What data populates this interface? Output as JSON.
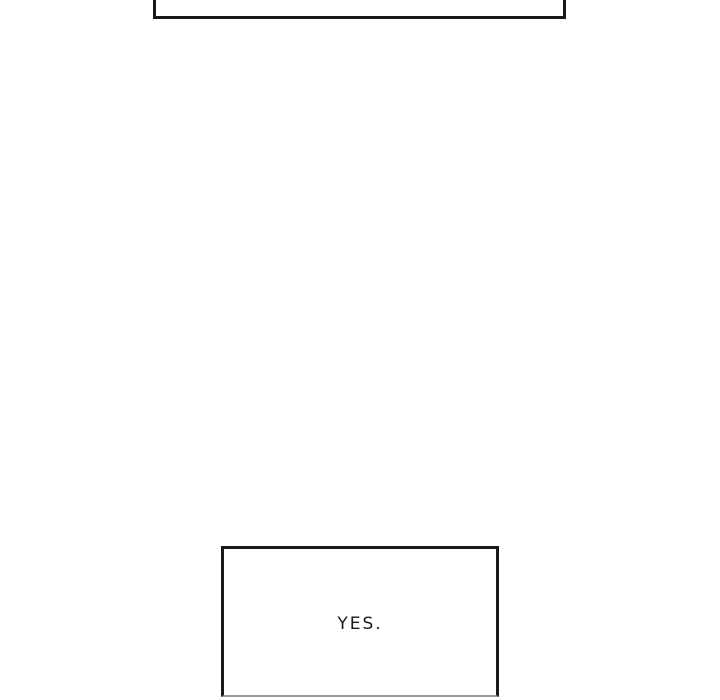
{
  "comic": {
    "background_color": "#ffffff",
    "panel_border_color": "#1a1a1a",
    "panel_bottom_edge_color": "#9a9a9a",
    "panels": [
      {
        "name": "top-panel-partial",
        "text": ""
      },
      {
        "name": "dialogue-panel",
        "text": "YES."
      }
    ]
  }
}
